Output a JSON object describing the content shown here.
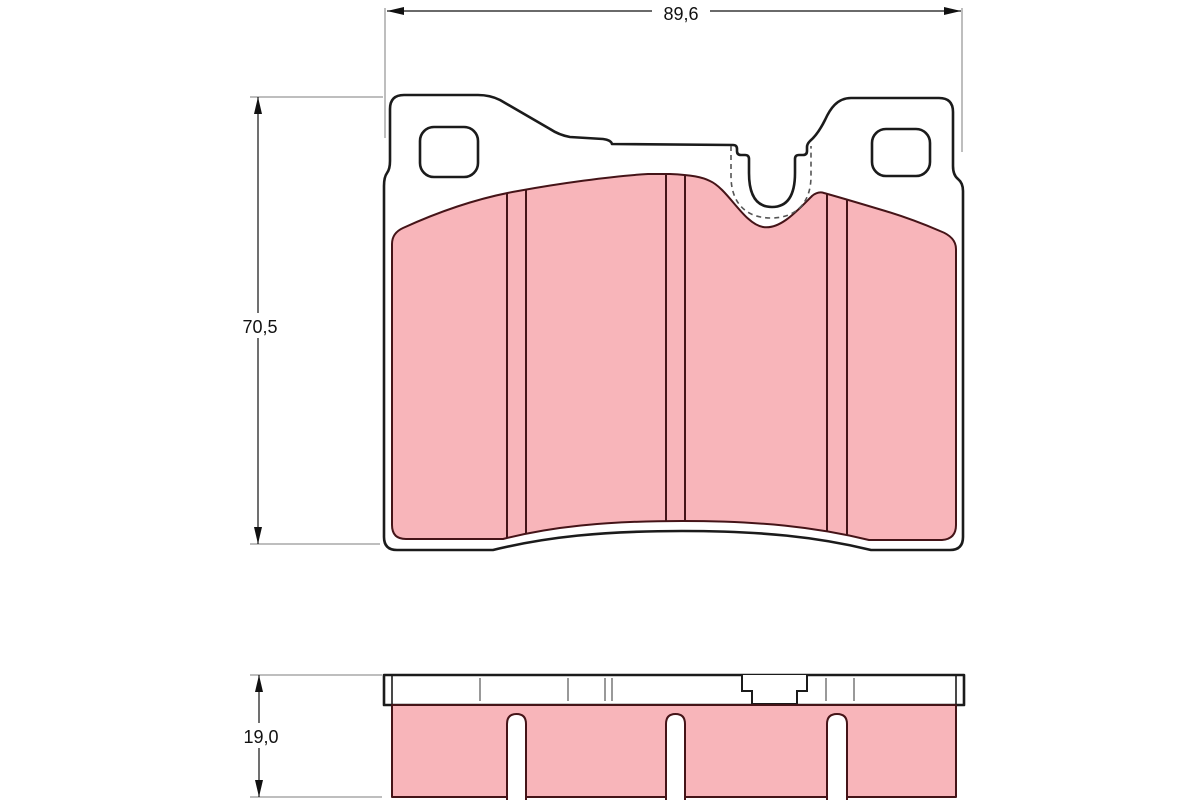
{
  "drawing": {
    "kind": "brake-pad-technical-drawing",
    "views": {
      "front": "front-profile-view",
      "side": "thickness-profile-view"
    }
  },
  "dimensions": {
    "width_label": "89,6",
    "height_label": "70,5",
    "thickness_label": "19,0"
  },
  "colors": {
    "background": "#ffffff",
    "outline": "#1b1b1b",
    "friction_fill": "#f8b5ba",
    "friction_outline": "#451418",
    "dimension_line": "#7d7d7d",
    "text": "#111111"
  }
}
